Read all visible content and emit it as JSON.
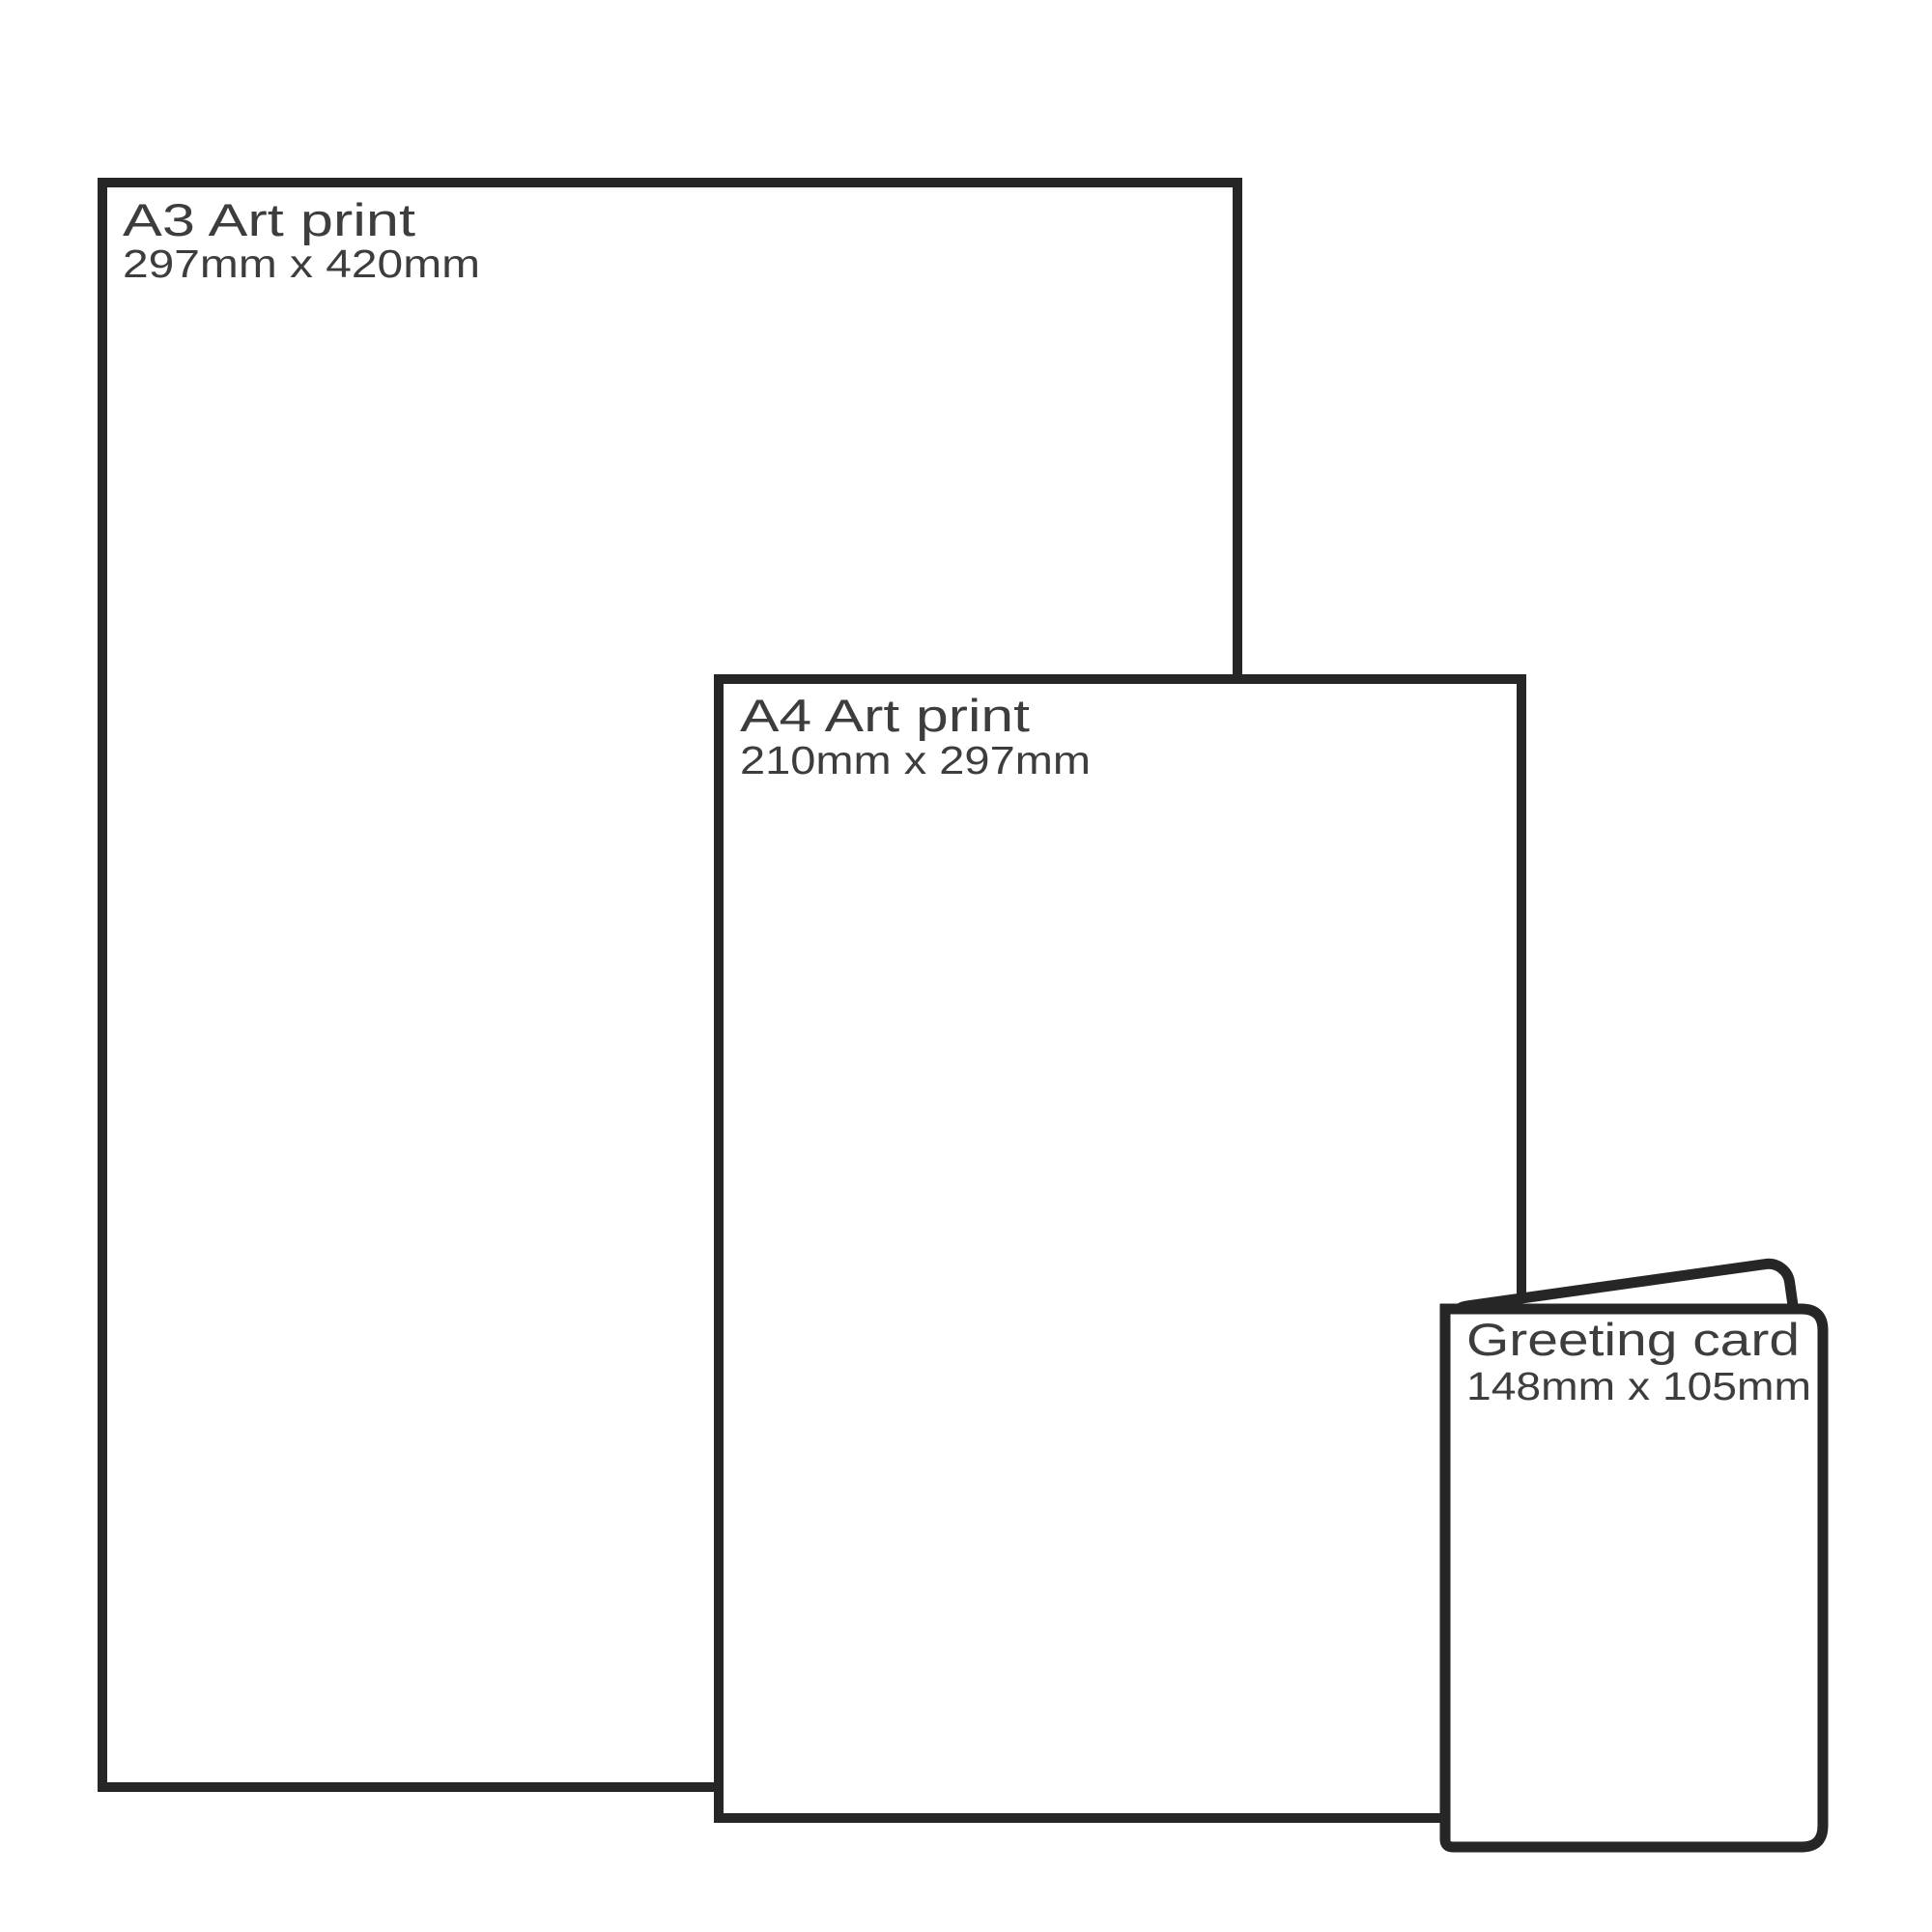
{
  "diagram": {
    "description": "Print size comparison diagram",
    "colors": {
      "background": "#ffffff",
      "outline": "#262626",
      "text": "#3d3d3d"
    },
    "items": [
      {
        "id": "a3-art-print",
        "title": "A3 Art print",
        "dimensions": "297mm x 420mm"
      },
      {
        "id": "a4-art-print",
        "title": "A4 Art print",
        "dimensions": "210mm x 297mm"
      },
      {
        "id": "greeting-card",
        "title": "Greeting card",
        "dimensions": "148mm x 105mm"
      }
    ]
  }
}
